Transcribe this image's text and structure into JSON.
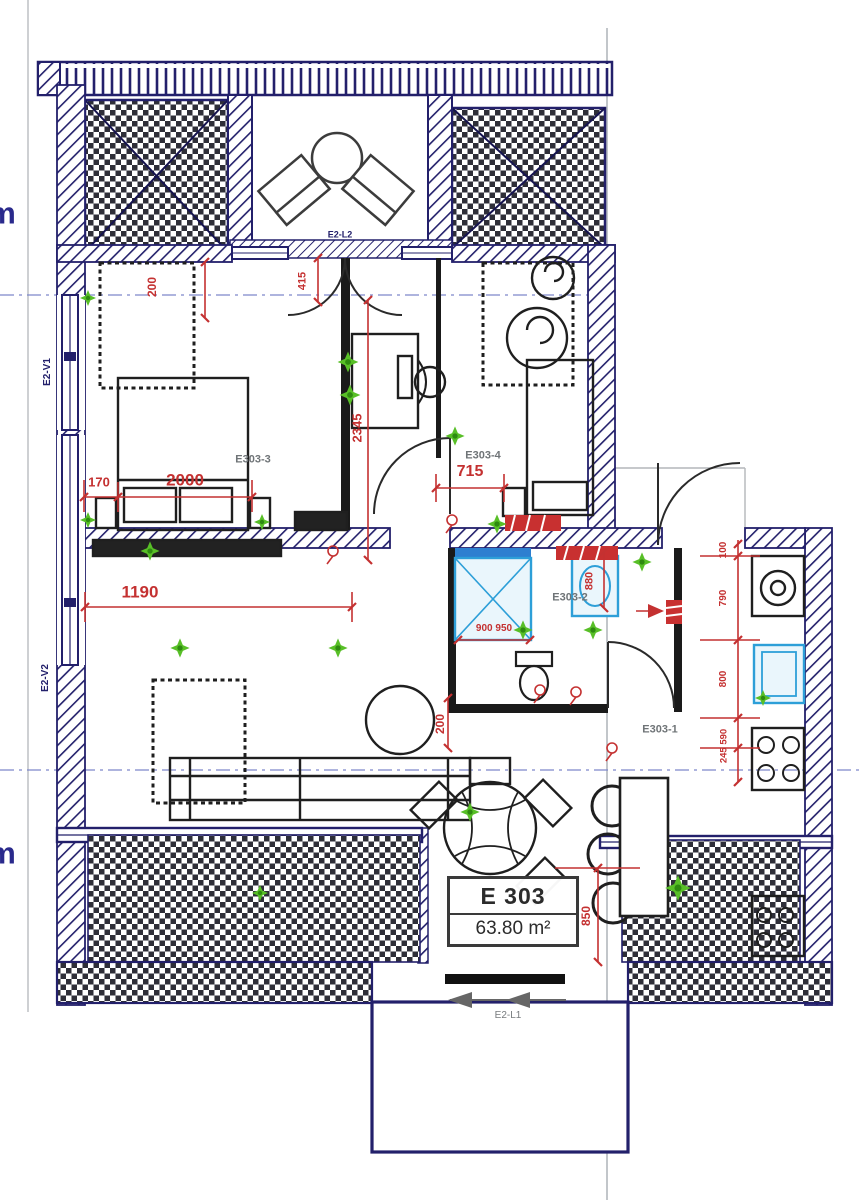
{
  "unit": {
    "id": "E 303",
    "area": "63.80 m²"
  },
  "rooms": {
    "hall": "E303-1",
    "bathroom": "E303-2",
    "bedroom_left": "E303-3",
    "bedroom_right": "E303-4"
  },
  "openings": {
    "window1": "E2-V1",
    "window2": "E2-V2",
    "entry_door": "E2-L1",
    "balcony_door": "E2-L2"
  },
  "dimensions": {
    "wardrobe_depth": "200",
    "bed_offset": "170",
    "bed_width": "2000",
    "living_wall": "1190",
    "door_width": "415",
    "corridor_length": "2345",
    "bedroom2_door": "715",
    "bath_width": "880",
    "shower_size": "900 950",
    "bath_door": "200",
    "terrace_depth": "850",
    "hall_seg_top": "100",
    "hall_seg_a": "790",
    "hall_seg_b": "800",
    "hall_seg_c": "245 590"
  },
  "edge_text": {
    "upper": "m",
    "lower": "m"
  },
  "colors": {
    "wall": "#23206b",
    "partition": "#1a1a1a",
    "dimension": "#c43131",
    "marker": "#58bf27",
    "fixture": "#2d9fd8",
    "centerline": "#7d88c9"
  }
}
